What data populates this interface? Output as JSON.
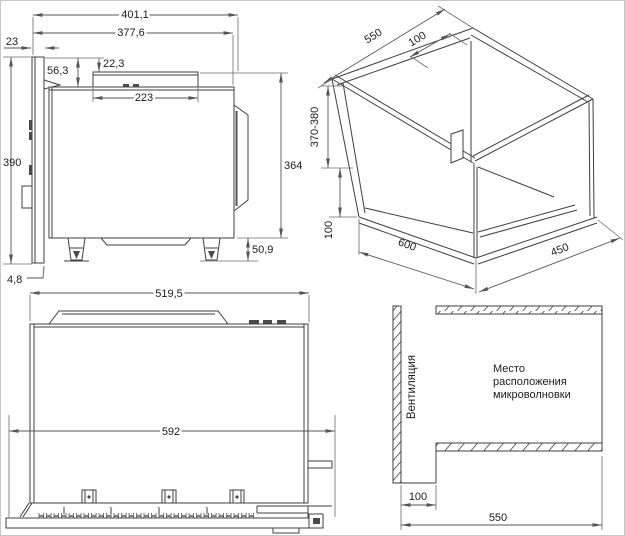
{
  "side_view": {
    "width_overall": "401,1",
    "width_body": "377,6",
    "door_thickness": "23",
    "top_inset": "56,3",
    "cap_height": "22,3",
    "cap_width": "223",
    "height_overall": "390",
    "height_body": "364",
    "feet_height": "50,9",
    "door_bottom_gap": "4,8"
  },
  "niche_view": {
    "depth_top": "550",
    "gap_top": "100",
    "height_range": "370-380",
    "gap_bottom": "100",
    "width": "600",
    "depth_bottom": "450"
  },
  "front_view": {
    "width_body": "519,5",
    "width_frame": "592"
  },
  "placement_view": {
    "ventilation": "Вентиляция",
    "caption_line1": "Место",
    "caption_line2": "расположения",
    "caption_line3": "микроволновки",
    "gap": "100",
    "width": "550"
  }
}
